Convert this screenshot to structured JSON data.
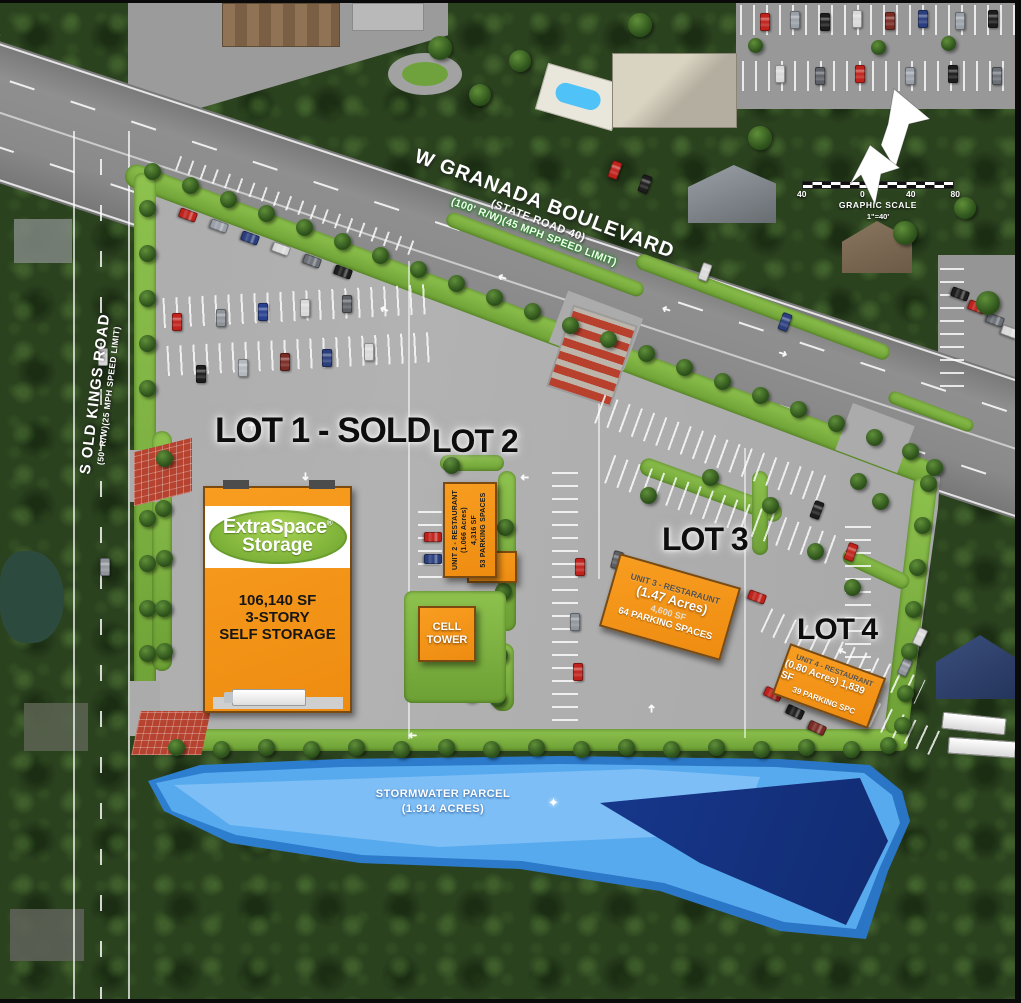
{
  "map": {
    "roads": {
      "granada_name": "W GRANADA BOULEVARD",
      "granada_state": "(STATE ROAD 40)",
      "granada_row": "(100' R/W)(45 MPH SPEED LIMIT)",
      "old_kings_name": "S OLD KINGS ROAD",
      "old_kings_row": "(50' R/W)(25 MPH SPEED LIMIT)",
      "old_kings_small": "S Old Kings Rd"
    },
    "lots": {
      "lot1_label": "LOT 1 - SOLD",
      "lot2_label": "LOT 2",
      "lot3_label": "LOT 3",
      "lot4_label": "LOT 4"
    },
    "storage_building": {
      "brand_top": "ExtraSpace",
      "brand_reg": "®",
      "brand_bottom": "Storage",
      "area": "106,140 SF",
      "stories": "3-STORY",
      "use": "SELF STORAGE"
    },
    "unit2": {
      "line1": "UNIT 2 - RESTAURANT",
      "line2": "(1.066 Acres)",
      "line3": "4,316 SF",
      "line4": "53 PARKING SPACES"
    },
    "cell_tower": {
      "line1": "CELL",
      "line2": "TOWER"
    },
    "unit3": {
      "line1": "UNIT 3 - RESTARAUNT",
      "line2": "(1.47 Acres)",
      "line3": "4,600 SF",
      "line4": "64 PARKING SPACES"
    },
    "unit4": {
      "line1": "UNIT 4 - RESTAURANT",
      "line2": "(0.80 Acres) 1,839 SF",
      "line3": "39 PARKING SPC"
    },
    "stormwater": {
      "line1": "STORMWATER PARCEL",
      "line2": "(1.914 ACRES)"
    },
    "scale_bar": {
      "tick_labels": [
        "40",
        "0",
        "40",
        "80"
      ],
      "title": "GRAPHIC SCALE",
      "ratio": "1\"=40'"
    },
    "colors": {
      "building_orange": "#F6921E",
      "brand_green": "#8CC63E",
      "lawn_green": "#7CB23E",
      "pond_outer": "#2E7FD0",
      "pond_inner": "#58AAEE",
      "pond_deep": "#16368C",
      "pavement": "#ABABAB"
    }
  }
}
